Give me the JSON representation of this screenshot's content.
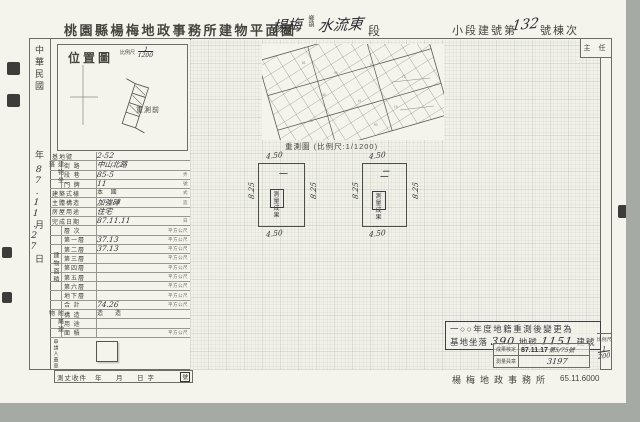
{
  "header": {
    "title": "桃園縣楊梅地政事務所建物平面圖",
    "township_hw": "楊梅",
    "township_label": "鄉鎮",
    "section_hw": "水流東",
    "section_label": "段",
    "subsection_label": "小段建號第",
    "building_no_hw": "132",
    "building_no_suffix": "號棟次",
    "examiner_box": "主 任"
  },
  "date_column": {
    "era": "中華民國",
    "year": "年",
    "date_hw": "87.11.27",
    "month": "月",
    "day": "日"
  },
  "location_box": {
    "title": "位置圖",
    "scale_label": "比例尺",
    "scale_num": "1",
    "scale_den": "1200",
    "annotation": "重測前"
  },
  "cadastral": {
    "caption": "重測圖 (比例尺:1/1200)"
  },
  "table": {
    "groups": {
      "address": "建物坐落",
      "area": "建物面積",
      "annex": "附屬建物",
      "applicant": "申請人蓋章"
    },
    "rows": [
      {
        "label": "基地號",
        "value": "2-52",
        "unit": ""
      },
      {
        "label": "街 路",
        "value": "中山北路",
        "unit": ""
      },
      {
        "label": "段 巷",
        "value": "85-5",
        "unit": "弄"
      },
      {
        "label": "門 牌",
        "value": "11",
        "unit": "號"
      },
      {
        "label": "建築式樣",
        "value": "本 國",
        "unit": "式"
      },
      {
        "label": "主體構造",
        "value": "加強磚",
        "unit": "造"
      },
      {
        "label": "房屋用途",
        "value": "住宅",
        "unit": ""
      },
      {
        "label": "完成日期",
        "value": "87.11.11",
        "unit": "日"
      },
      {
        "label": "層 次",
        "value": "",
        "unit": "平方公尺"
      },
      {
        "label": "第一層",
        "value": "37.13",
        "unit": "平方公尺"
      },
      {
        "label": "第二層",
        "value": "37.13",
        "unit": "平方公尺"
      },
      {
        "label": "第三層",
        "value": "",
        "unit": "平方公尺"
      },
      {
        "label": "第四層",
        "value": "",
        "unit": "平方公尺"
      },
      {
        "label": "第五層",
        "value": "",
        "unit": "平方公尺"
      },
      {
        "label": "第六層",
        "value": "",
        "unit": "平方公尺"
      },
      {
        "label": "地下層",
        "value": "",
        "unit": "平方公尺"
      },
      {
        "label": "合 計",
        "value": "74.26",
        "unit": "平方公尺"
      },
      {
        "label": "構 造",
        "value": "造　　造",
        "unit": ""
      },
      {
        "label": "用 途",
        "value": "",
        "unit": ""
      },
      {
        "label": "面 積",
        "value": "",
        "unit": "平方公尺"
      }
    ]
  },
  "floor_plans": [
    {
      "name": "一",
      "top": "4.50",
      "bottom": "4.50",
      "left": "8.25",
      "right": "8.25",
      "stamp": "測量成果"
    },
    {
      "name": "二",
      "top": "4.50",
      "bottom": "4.50",
      "left": "8.25",
      "right": "8.25",
      "stamp": "測量成果"
    }
  ],
  "remeasure_stamp": {
    "line1": "一○○年度地籍重測後變更為",
    "line2_prefix": "基地坐落",
    "lot_hw": "390",
    "lot_label": "地號",
    "bldg_hw": "1151",
    "bldg_label": "建號"
  },
  "result_table": {
    "r1_label": "成果核定",
    "r1_date": "87.11.17",
    "r1_no": "第5/75號",
    "r2_label": "測量員章",
    "r2_value": "3197"
  },
  "scale_box": {
    "label": "比例尺",
    "num": "1",
    "den": "200"
  },
  "footer": {
    "receipt": "測丈收件",
    "receipt_fields": "年　月　日字",
    "receipt_no": "號",
    "office": "楊梅地政事務所",
    "print_code": "65.11.6000"
  }
}
